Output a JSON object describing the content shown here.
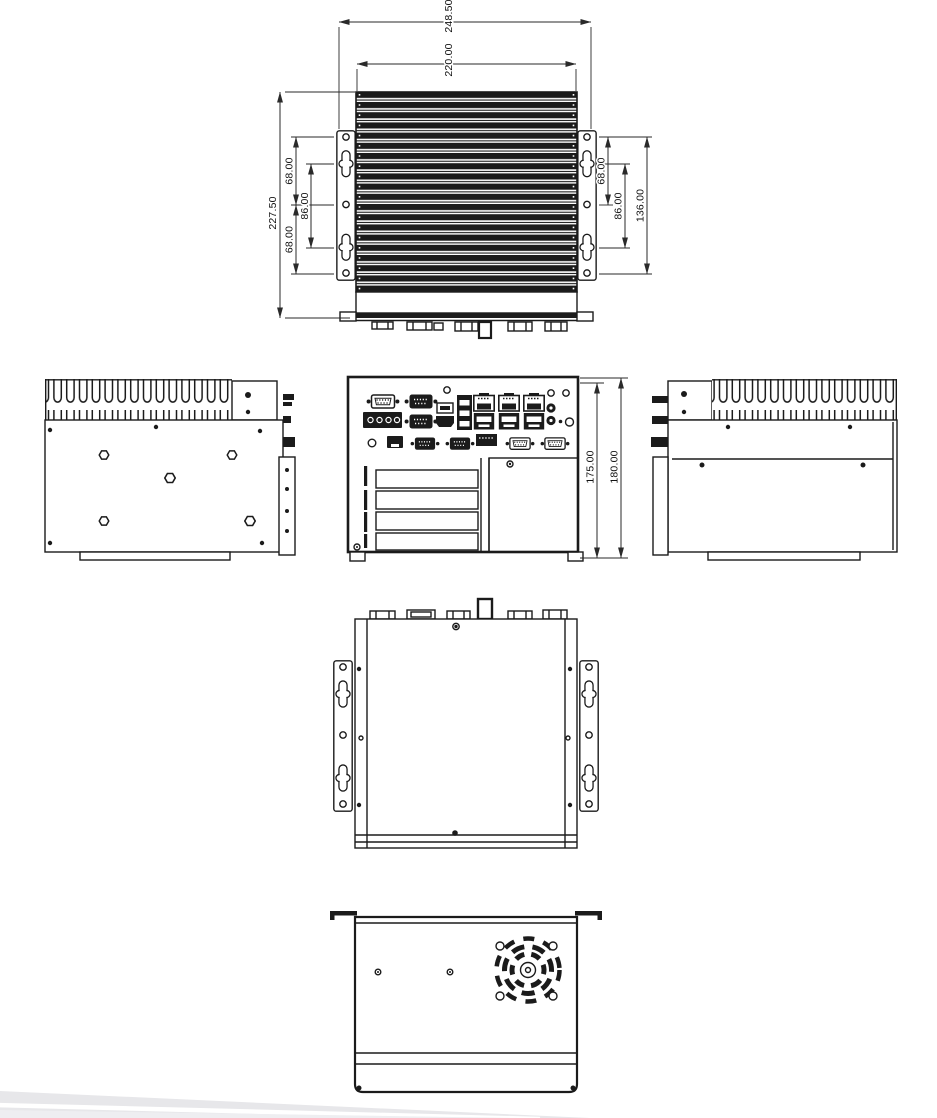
{
  "views": {
    "top": {
      "dims": {
        "overall_width": "248.50",
        "body_width": "220.00",
        "overall_depth": "227.50",
        "left_top_hole_pitch": "68.00",
        "left_slot_pitch": "86.00",
        "left_bottom_hole_pitch": "68.00",
        "right_hole_pitch": "68.00",
        "right_slot_pitch": "86.00",
        "right_outer_hole_pitch": "136.00"
      }
    },
    "rear": {
      "dims": {
        "chassis_height": "175.00",
        "overall_height": "180.00"
      }
    }
  }
}
